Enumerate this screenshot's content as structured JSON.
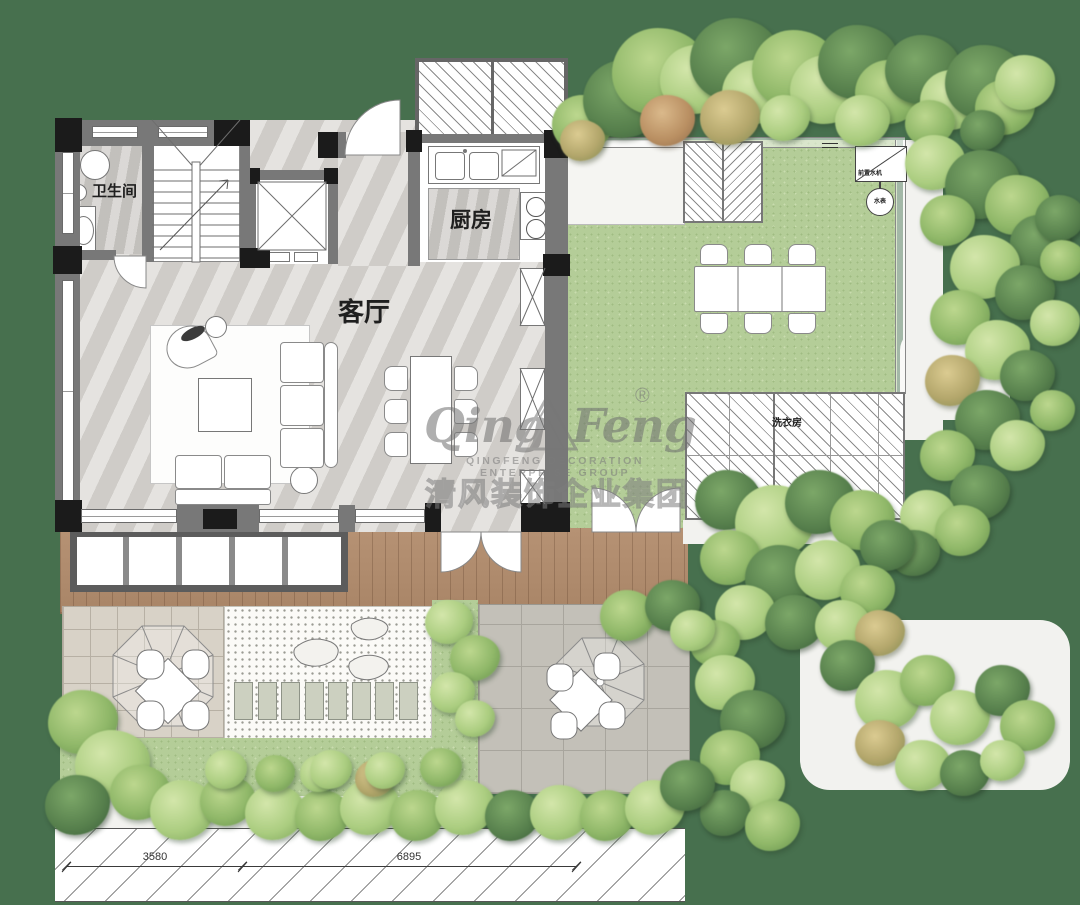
{
  "background_color": "#47704e",
  "rooms": {
    "bathroom": "卫生间",
    "living_room": "客厅",
    "kitchen": "厨房",
    "laundry_room": "洗衣房"
  },
  "garden": {
    "equipment_box_label": "前置水机",
    "water_meter_label": "水表"
  },
  "dimensions": {
    "left": "3580",
    "right": "6895"
  },
  "watermark": {
    "script_left": "Qing",
    "script_right": "Feng",
    "registered": "®",
    "subtitle_en": "QINGFENG DECORATION ENTERPRISE GROUP",
    "subtitle_cn": "清风装饰企业集团"
  },
  "colors": {
    "background": "#47704e",
    "lawn": "#b4cd98",
    "deck_wood": "#b28e70",
    "patio_beige": "#d8d2c7",
    "patio_gray": "#c3c0b8",
    "wall": "#787878",
    "wall_dark": "#1b1b1b",
    "watermark_gray": "#7d7d7d"
  }
}
